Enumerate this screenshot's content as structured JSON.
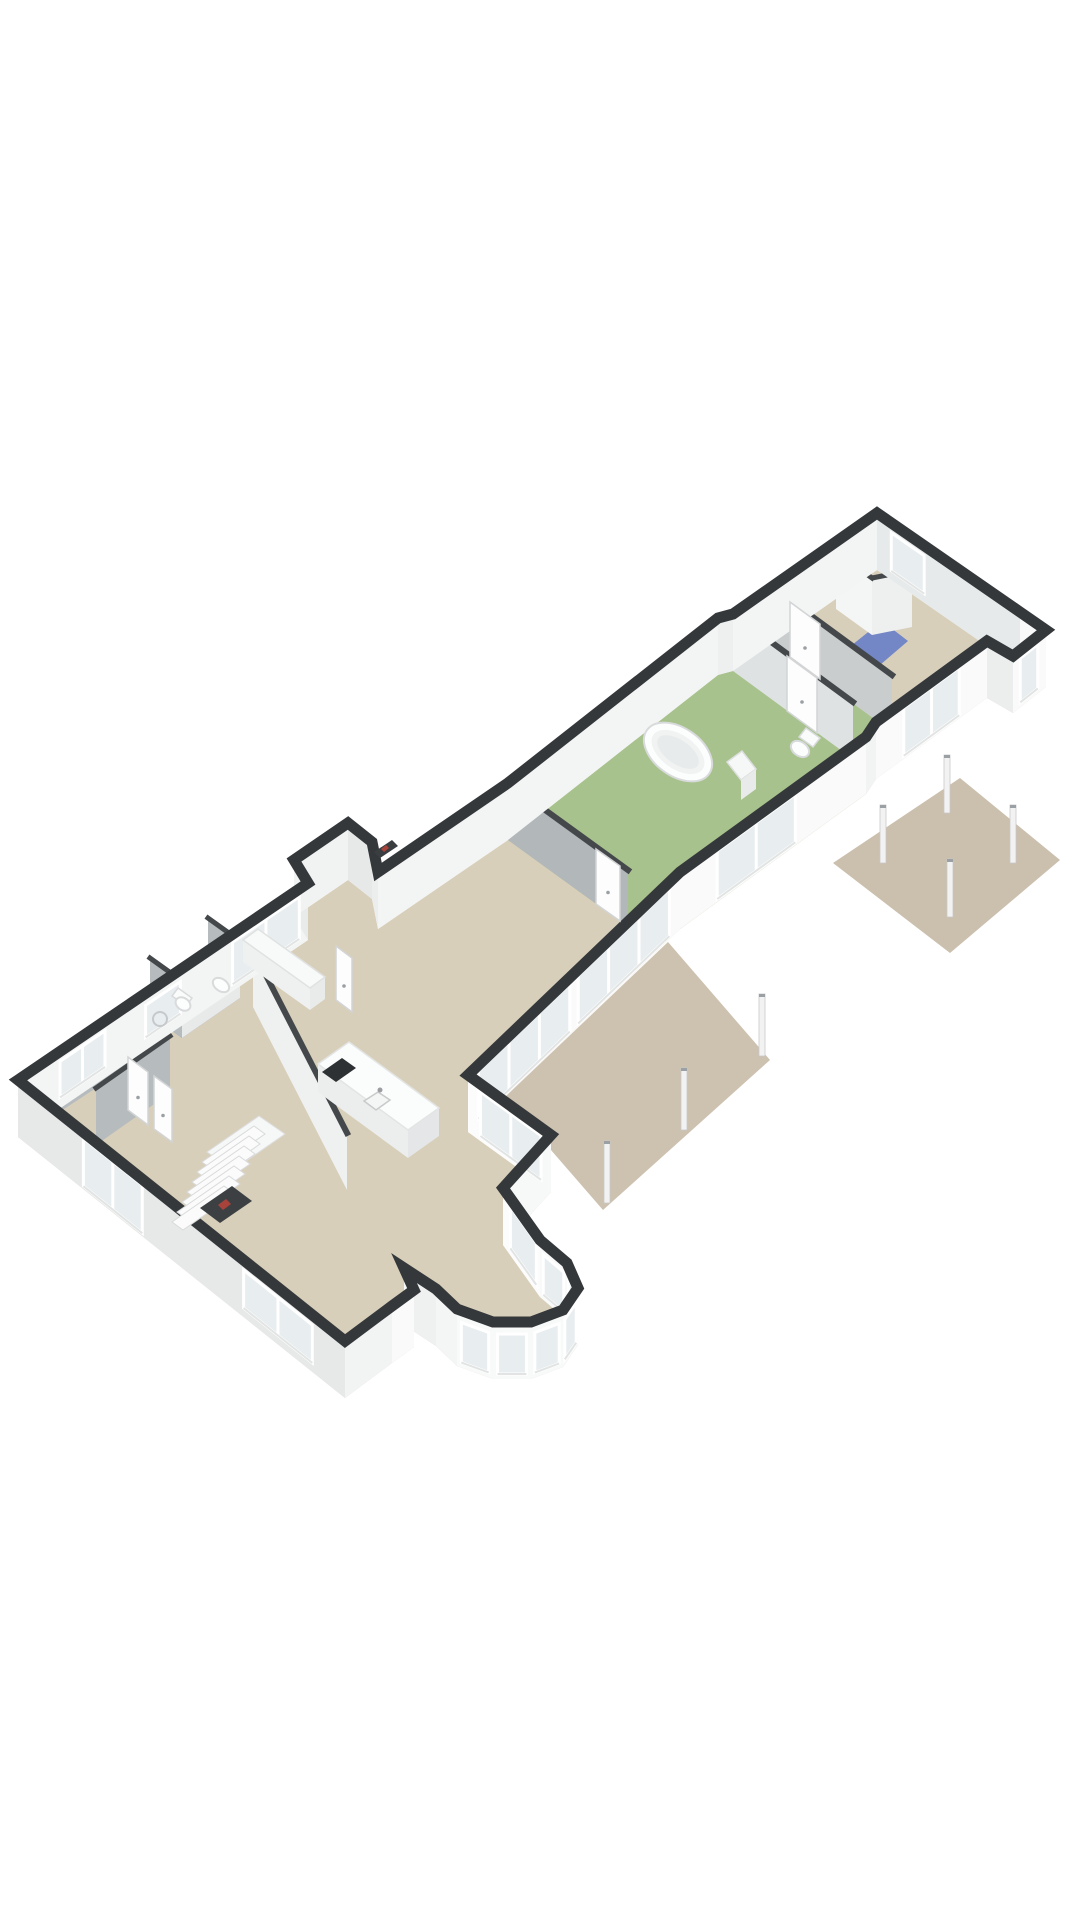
{
  "scene": {
    "name": "3d-floor-plan-isometric",
    "canvas": {
      "w": 1080,
      "h": 1920,
      "wall_height": 57
    },
    "colors": {
      "background": "#ffffff",
      "wall_cap": "#34383b",
      "interior_cap": "#44484b",
      "floor_beige": "#d8cfba",
      "floor_green": "#a7c28c",
      "floor_blue": "#7386c5",
      "patio_taupe": "#cdc1b0",
      "glass": "#e8edf0",
      "frame_white": "#ffffff",
      "fixture_white": "#fcfdfd",
      "fixture_stroke": "#d8dadb",
      "cooktop_black": "#2e3133",
      "shadow_gray": "#b2b7ba"
    }
  },
  "exterior": {
    "outline": [
      [
        18,
        1080
      ],
      [
        308,
        883
      ],
      [
        294,
        860
      ],
      [
        348,
        823
      ],
      [
        372,
        842
      ],
      [
        378,
        872
      ],
      [
        508,
        783
      ],
      [
        718,
        618
      ],
      [
        733,
        614
      ],
      [
        877,
        513
      ],
      [
        1020,
        612
      ],
      [
        1046,
        630
      ],
      [
        1013,
        656
      ],
      [
        987,
        641
      ],
      [
        876,
        722
      ],
      [
        866,
        737
      ],
      [
        680,
        872
      ],
      [
        468,
        1075
      ],
      [
        551,
        1135
      ],
      [
        503,
        1188
      ],
      [
        540,
        1240
      ],
      [
        567,
        1263
      ],
      [
        578,
        1288
      ],
      [
        563,
        1310
      ],
      [
        531,
        1322
      ],
      [
        493,
        1322
      ],
      [
        457,
        1309
      ],
      [
        436,
        1289
      ],
      [
        404,
        1268
      ],
      [
        414,
        1290
      ],
      [
        392,
        1306
      ],
      [
        345,
        1341
      ]
    ],
    "face_fills": [
      "#f3f4f4",
      "#e9ebeb",
      "#f1f2f2",
      "#e7e9e9",
      "#eceeee",
      "#f3f4f4",
      "#f3f4f4",
      "#eef0f0",
      "#f3f4f4",
      "#e7eaeb",
      "#f9f9f9",
      "#fafafa",
      "#eceeee",
      "#fafafa",
      "#f2f3f3",
      "#fafafa",
      "#fafafa",
      "#fcfcfc",
      "#f7f8f8",
      "#fcfcfc",
      "#f8f9f9",
      "#f8f9f9",
      "#f8f9f9",
      "#f8f9f9",
      "#f8f9f9",
      "#f8f9f9",
      "#f4f5f5",
      "#eff0f0",
      "#f7f8f8",
      "#fafafa",
      "#f2f3f3",
      "#e7e9e9"
    ]
  },
  "glazing": [
    {
      "name": "window-left-entry",
      "seg": 0,
      "t0": 0.145,
      "t1": 0.3,
      "top": 10,
      "bot": 46,
      "m": 1
    },
    {
      "name": "window-left-bath",
      "seg": 0,
      "t0": 0.44,
      "t1": 0.56,
      "top": 12,
      "bot": 44,
      "m": 0
    },
    {
      "name": "window-living-nw",
      "seg": 0,
      "t0": 0.74,
      "t1": 0.97,
      "top": 8,
      "bot": 50,
      "m": 1
    },
    {
      "name": "window-top-bath",
      "seg": 9,
      "t0": 0.1,
      "t1": 0.33,
      "top": 10,
      "bot": 48,
      "m": 0
    },
    {
      "name": "door-porch-glass",
      "seg": 11,
      "t0": 0.25,
      "t1": 0.78,
      "top": 8,
      "bot": 52,
      "m": 0
    },
    {
      "name": "slider-bedroom-se",
      "seg": 13,
      "t0": 0.25,
      "t1": 0.75,
      "top": 6,
      "bot": 54,
      "m": 1
    },
    {
      "name": "slider-bathroom-se",
      "seg": 15,
      "t0": 0.38,
      "t1": 0.8,
      "top": 6,
      "bot": 54,
      "m": 1
    },
    {
      "name": "slider-corridor-1",
      "seg": 16,
      "t0": 0.05,
      "t1": 0.48,
      "top": 6,
      "bot": 54,
      "m": 2
    },
    {
      "name": "slider-corridor-2",
      "seg": 16,
      "t0": 0.52,
      "t1": 0.95,
      "top": 6,
      "bot": 54,
      "m": 2
    },
    {
      "name": "window-living-ne",
      "seg": 17,
      "t0": 0.15,
      "t1": 0.88,
      "top": 8,
      "bot": 52,
      "m": 1
    },
    {
      "name": "window-bay-upper",
      "seg": 19,
      "t0": 0.2,
      "t1": 0.9,
      "top": 8,
      "bot": 50,
      "m": 0
    },
    {
      "name": "window-bay-1",
      "seg": 20,
      "t0": 0.12,
      "t1": 0.88,
      "top": 12,
      "bot": 52,
      "m": 0
    },
    {
      "name": "window-bay-2",
      "seg": 21,
      "t0": 0.12,
      "t1": 0.88,
      "top": 12,
      "bot": 52,
      "m": 0
    },
    {
      "name": "window-bay-3",
      "seg": 22,
      "t0": 0.12,
      "t1": 0.88,
      "top": 12,
      "bot": 52,
      "m": 0
    },
    {
      "name": "window-bay-4",
      "seg": 23,
      "t0": 0.12,
      "t1": 0.88,
      "top": 12,
      "bot": 52,
      "m": 0
    },
    {
      "name": "window-bay-5",
      "seg": 24,
      "t0": 0.12,
      "t1": 0.88,
      "top": 12,
      "bot": 52,
      "m": 0
    },
    {
      "name": "window-bay-6",
      "seg": 25,
      "t0": 0.12,
      "t1": 0.88,
      "top": 12,
      "bot": 52,
      "m": 0
    },
    {
      "name": "window-sw-wall",
      "seg": 31,
      "t0": 0.1,
      "t1": 0.31,
      "top": 10,
      "bot": 48,
      "m": 1
    },
    {
      "name": "door-sw-glass",
      "seg": 31,
      "t0": 0.62,
      "t1": 0.8,
      "top": 6,
      "bot": 54,
      "m": 1
    }
  ],
  "interior_walls": [
    {
      "name": "wall-toilet-top-b",
      "p1": [
        872,
        578
      ],
      "p2": [
        912,
        570
      ],
      "face": "#eef0f0",
      "capw": 5
    },
    {
      "name": "wall-toilet-top-a",
      "p1": [
        836,
        552
      ],
      "p2": [
        872,
        578
      ],
      "face": "#f4f5f5",
      "capw": 5
    },
    {
      "name": "wall-hall-bedroom",
      "p1": [
        772,
        587
      ],
      "p2": [
        892,
        675
      ],
      "face": "#c9cdce",
      "capw": 6
    },
    {
      "name": "wall-bath-hall",
      "p1": [
        733,
        614
      ],
      "p2": [
        853,
        702
      ],
      "face": "#dfe2e3",
      "capw": 6
    },
    {
      "name": "wall-corridor-bath",
      "p1": [
        508,
        783
      ],
      "p2": [
        628,
        870
      ],
      "face": "#b2b7ba",
      "capw": 6
    },
    {
      "name": "wall-leftbath-e",
      "p1": [
        208,
        918
      ],
      "p2": [
        240,
        941
      ],
      "face": "#b6bbbe",
      "capw": 5
    },
    {
      "name": "wall-leftbath-se",
      "p1": [
        240,
        941
      ],
      "p2": [
        182,
        981
      ],
      "face": "#e8eaea",
      "capw": 5
    },
    {
      "name": "wall-leftbath-w",
      "p1": [
        150,
        958
      ],
      "p2": [
        182,
        981
      ],
      "face": "#b6bbbe",
      "capw": 5
    },
    {
      "name": "wall-entry",
      "p1": [
        52,
        1060
      ],
      "p2": [
        140,
        1002
      ],
      "face": "#b6bbbe",
      "capw": 5
    },
    {
      "name": "wall-storage",
      "p1": [
        96,
        1088
      ],
      "p2": [
        170,
        1036
      ],
      "face": "#b6bbbe",
      "capw": 5
    },
    {
      "name": "wall-living-divider",
      "p1": [
        253,
        950
      ],
      "p2": [
        347,
        1133
      ],
      "face": "#eff1f1",
      "capw": 6
    }
  ],
  "rooms": [
    {
      "name": "floor-green-bathroom",
      "fill": "#a7c28c",
      "points": [
        [
          508,
          840
        ],
        [
          718,
          675
        ],
        [
          733,
          671
        ],
        [
          772,
          644
        ],
        [
          892,
          732
        ],
        [
          866,
          794
        ],
        [
          680,
          929
        ],
        [
          628,
          927
        ]
      ]
    },
    {
      "name": "floor-blue-toilet-top",
      "fill": "#7386c5",
      "points": [
        [
          852,
          645
        ],
        [
          880,
          665
        ],
        [
          908,
          641
        ],
        [
          882,
          621
        ]
      ]
    },
    {
      "name": "floor-blue-bathroom-left",
      "fill": "#7386c5",
      "points": [
        [
          150,
          1015
        ],
        [
          208,
          975
        ],
        [
          240,
          998
        ],
        [
          182,
          1038
        ]
      ]
    }
  ],
  "patios": [
    {
      "name": "patio-middle",
      "fill": "#cdc1b0",
      "points": [
        [
          668,
          942
        ],
        [
          770,
          1060
        ],
        [
          603,
          1210
        ],
        [
          505,
          1097
        ]
      ],
      "posts": [
        [
          762,
          1056,
          62
        ],
        [
          684,
          1130,
          62
        ],
        [
          607,
          1203,
          62
        ]
      ]
    },
    {
      "name": "patio-right",
      "fill": "#cbbfae",
      "points": [
        [
          833,
          863
        ],
        [
          960,
          778
        ],
        [
          1060,
          860
        ],
        [
          950,
          953
        ]
      ],
      "posts": [
        [
          947,
          813,
          58
        ],
        [
          883,
          863,
          58
        ],
        [
          1013,
          863,
          58
        ],
        [
          950,
          917,
          58
        ]
      ]
    }
  ],
  "stairs": {
    "name": "staircase",
    "base": [
      172,
      1222
    ],
    "steps": 7,
    "stepdx": 5,
    "stepdy": -10,
    "run": [
      52,
      -36
    ],
    "depth": [
      11,
      8
    ],
    "landing": [
      [
        207,
        1152
      ],
      [
        259,
        1116
      ],
      [
        285,
        1134
      ],
      [
        233,
        1170
      ]
    ],
    "void": [
      [
        200,
        1208
      ],
      [
        232,
        1186
      ],
      [
        252,
        1201
      ],
      [
        220,
        1223
      ]
    ],
    "void_fill": "#3c4043",
    "accent": [
      [
        218,
        1205
      ],
      [
        226,
        1199
      ],
      [
        231,
        1204
      ],
      [
        223,
        1210
      ]
    ],
    "accent_fill": "#a8433c"
  },
  "fixtures": [
    {
      "name": "kitchen-island-side-sw",
      "kind": "poly",
      "points": [
        [
          318,
          1064
        ],
        [
          408,
          1130
        ],
        [
          408,
          1158
        ],
        [
          318,
          1092
        ]
      ],
      "fill": "#eceeee"
    },
    {
      "name": "kitchen-island-side-se",
      "kind": "poly",
      "points": [
        [
          408,
          1130
        ],
        [
          439,
          1108
        ],
        [
          439,
          1136
        ],
        [
          408,
          1158
        ]
      ],
      "fill": "#e4e6e7"
    },
    {
      "name": "kitchen-island-top",
      "kind": "poly",
      "points": [
        [
          318,
          1064
        ],
        [
          349,
          1042
        ],
        [
          439,
          1108
        ],
        [
          408,
          1130
        ]
      ],
      "fill": "#fbfcfc",
      "stroke": "#e3e5e5"
    },
    {
      "name": "cooktop",
      "kind": "poly",
      "points": [
        [
          322,
          1072
        ],
        [
          342,
          1058
        ],
        [
          356,
          1068
        ],
        [
          336,
          1082
        ]
      ],
      "fill": "#2e3133"
    },
    {
      "name": "kitchen-sink",
      "kind": "poly",
      "points": [
        [
          364,
          1101
        ],
        [
          378,
          1092
        ],
        [
          390,
          1100
        ],
        [
          376,
          1110
        ]
      ],
      "fill": "#f4f5f5",
      "stroke": "#c8cacb"
    },
    {
      "name": "sink-faucet",
      "kind": "ellipse",
      "cx": 380,
      "cy": 1090,
      "rx": 2.5,
      "ry": 2.5,
      "rot": 0,
      "fill": "#9b9fa2"
    },
    {
      "name": "sideboard-side",
      "kind": "poly",
      "points": [
        [
          310,
          988
        ],
        [
          325,
          977
        ],
        [
          325,
          999
        ],
        [
          310,
          1010
        ]
      ],
      "fill": "#e9ebeb"
    },
    {
      "name": "sideboard-front",
      "kind": "poly",
      "points": [
        [
          243,
          940
        ],
        [
          310,
          988
        ],
        [
          310,
          1010
        ],
        [
          243,
          962
        ]
      ],
      "fill": "#eff1f1"
    },
    {
      "name": "sideboard-top",
      "kind": "poly",
      "points": [
        [
          243,
          940
        ],
        [
          258,
          929
        ],
        [
          325,
          977
        ],
        [
          310,
          988
        ]
      ],
      "fill": "#f8f9f9",
      "stroke": "#e0e2e2"
    },
    {
      "name": "box-room-shelf",
      "kind": "poly",
      "points": [
        [
          374,
          852
        ],
        [
          392,
          840
        ],
        [
          398,
          846
        ],
        [
          380,
          858
        ]
      ],
      "fill": "#3a3e41"
    },
    {
      "name": "box-room-books",
      "kind": "poly",
      "points": [
        [
          381,
          849
        ],
        [
          386,
          845
        ],
        [
          389,
          848
        ],
        [
          384,
          852
        ]
      ],
      "fill": "#a8433c"
    },
    {
      "name": "bathtub-outer",
      "kind": "ellipse",
      "cx": 678,
      "cy": 752,
      "rx": 38,
      "ry": 24,
      "rot": 35,
      "fill": "#fcfdfd",
      "stroke": "#d8dadb"
    },
    {
      "name": "bathtub-rim",
      "kind": "ellipse",
      "cx": 678,
      "cy": 752,
      "rx": 30,
      "ry": 17,
      "rot": 35,
      "fill": "#f1f3f3"
    },
    {
      "name": "bathtub-basin",
      "kind": "ellipse",
      "cx": 678,
      "cy": 752,
      "rx": 24,
      "ry": 12,
      "rot": 35,
      "fill": "#e8ebeb"
    },
    {
      "name": "toilet-green-tank",
      "kind": "poly",
      "points": [
        [
          806,
          728
        ],
        [
          820,
          738
        ],
        [
          813,
          747
        ],
        [
          799,
          737
        ]
      ],
      "fill": "#fafbfb",
      "stroke": "#d8dadb"
    },
    {
      "name": "toilet-green-bowl",
      "kind": "ellipse",
      "cx": 800,
      "cy": 749,
      "rx": 10,
      "ry": 7,
      "rot": 35,
      "fill": "#fcfdfd",
      "stroke": "#d8dadb"
    },
    {
      "name": "bath-cabinet-top",
      "kind": "poly",
      "points": [
        [
          727,
          762
        ],
        [
          742,
          751
        ],
        [
          756,
          769
        ],
        [
          741,
          780
        ]
      ],
      "fill": "#f6f7f7",
      "stroke": "#dddfdf"
    },
    {
      "name": "bath-cabinet-front",
      "kind": "poly",
      "points": [
        [
          741,
          780
        ],
        [
          756,
          769
        ],
        [
          756,
          789
        ],
        [
          741,
          800
        ]
      ],
      "fill": "#e9ebeb"
    },
    {
      "name": "toilet-left-tank",
      "kind": "poly",
      "points": [
        [
          178,
          988
        ],
        [
          192,
          998
        ],
        [
          186,
          1006
        ],
        [
          172,
          996
        ]
      ],
      "fill": "#fafbfb",
      "stroke": "#d8dadb"
    },
    {
      "name": "toilet-left-bowl",
      "kind": "ellipse",
      "cx": 183,
      "cy": 1004,
      "rx": 8,
      "ry": 6,
      "rot": 35,
      "fill": "#fcfdfd",
      "stroke": "#d8dadb"
    },
    {
      "name": "washbasin-left",
      "kind": "ellipse",
      "cx": 221,
      "cy": 985,
      "rx": 9,
      "ry": 6,
      "rot": 35,
      "fill": "#fcfdfd",
      "stroke": "#d8dadb"
    },
    {
      "name": "shower-drain",
      "kind": "ellipse",
      "cx": 160,
      "cy": 1019,
      "rx": 7,
      "ry": 7,
      "rot": 0,
      "fill": "none",
      "stroke": "#c6c9cb"
    }
  ],
  "doors": [
    {
      "name": "door-corridor-bath",
      "points": [
        [
          596,
          904
        ],
        [
          620,
          921
        ],
        [
          620,
          866
        ],
        [
          596,
          849
        ]
      ]
    },
    {
      "name": "door-hall-bedroom",
      "points": [
        [
          790,
          657
        ],
        [
          820,
          679
        ],
        [
          820,
          624
        ],
        [
          790,
          602
        ]
      ]
    },
    {
      "name": "door-bath-hall",
      "points": [
        [
          787,
          711
        ],
        [
          817,
          733
        ],
        [
          817,
          678
        ],
        [
          787,
          656
        ]
      ]
    },
    {
      "name": "door-left-1",
      "points": [
        [
          128,
          1110
        ],
        [
          148,
          1125
        ],
        [
          148,
          1072
        ],
        [
          128,
          1057
        ]
      ]
    },
    {
      "name": "door-left-2",
      "points": [
        [
          154,
          1129
        ],
        [
          172,
          1142
        ],
        [
          172,
          1089
        ],
        [
          154,
          1076
        ]
      ]
    },
    {
      "name": "door-hallway-living",
      "points": [
        [
          336,
          1000
        ],
        [
          352,
          1012
        ],
        [
          352,
          958
        ],
        [
          336,
          946
        ]
      ]
    }
  ]
}
